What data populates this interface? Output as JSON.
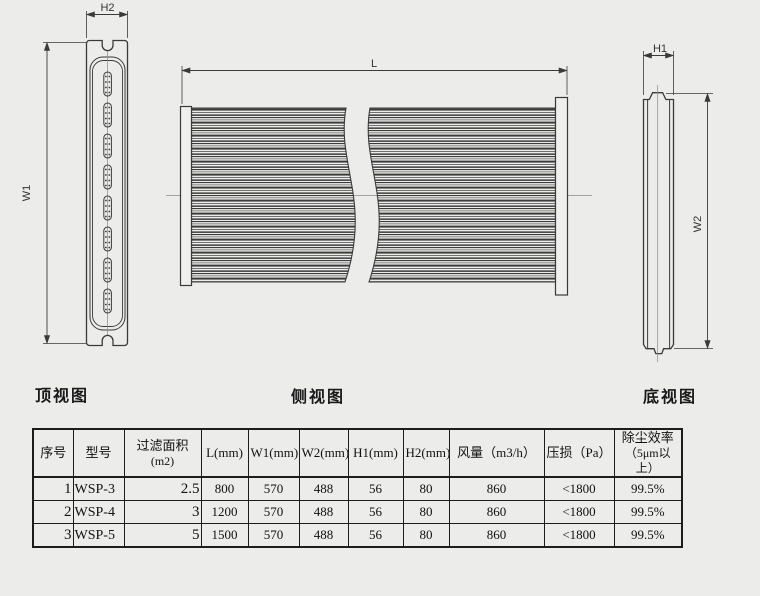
{
  "page": {
    "background": "#ececeb",
    "line_color": "#3a3a3a"
  },
  "views": {
    "top": {
      "label": "顶视图",
      "dims": {
        "h2": "H2",
        "w1": "W1"
      }
    },
    "side": {
      "label": "侧视图",
      "dims": {
        "l": "L"
      }
    },
    "bottom": {
      "label": "底视图",
      "dims": {
        "h1": "H1",
        "w2": "W2"
      }
    }
  },
  "table": {
    "headers": [
      {
        "line1": "序号",
        "line2": ""
      },
      {
        "line1": "型号",
        "line2": ""
      },
      {
        "line1": "过滤面积",
        "line2": "(m2)"
      },
      {
        "line1": "L(mm)",
        "line2": ""
      },
      {
        "line1": "W1(mm)",
        "line2": ""
      },
      {
        "line1": "W2(mm)",
        "line2": ""
      },
      {
        "line1": "H1(mm)",
        "line2": ""
      },
      {
        "line1": "H2(mm)",
        "line2": ""
      },
      {
        "line1": "风量（m3/h）",
        "line2": ""
      },
      {
        "line1": "压损（Pa）",
        "line2": ""
      },
      {
        "line1": "除尘效率",
        "line2": "（5μm以上）"
      }
    ],
    "rows": [
      [
        "1",
        "WSP-3",
        "2.5",
        "800",
        "570",
        "488",
        "56",
        "80",
        "860",
        "<1800",
        "99.5%"
      ],
      [
        "2",
        "WSP-4",
        "3",
        "1200",
        "570",
        "488",
        "56",
        "80",
        "860",
        "<1800",
        "99.5%"
      ],
      [
        "3",
        "WSP-5",
        "5",
        "1500",
        "570",
        "488",
        "56",
        "80",
        "860",
        "<1800",
        "99.5%"
      ]
    ]
  }
}
